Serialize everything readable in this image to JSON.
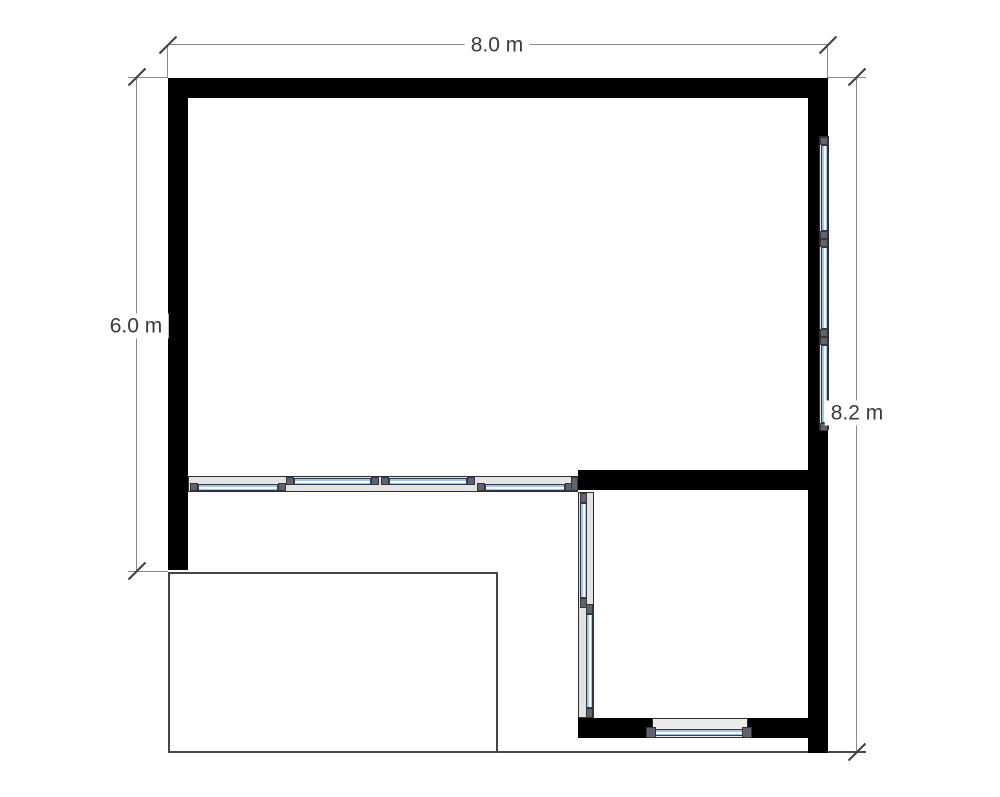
{
  "plan": {
    "dimensions": {
      "top": {
        "label": "8.0 m",
        "orientation": "horizontal"
      },
      "left": {
        "label": "6.0 m",
        "orientation": "vertical"
      },
      "right": {
        "label": "8.2 m",
        "orientation": "vertical"
      }
    },
    "colors": {
      "wall": "#000000",
      "window_glass": "#a4c4ea",
      "window_frame_band": "#e3e3e3",
      "window_cap": "#60646a",
      "dimension_line": "#8a8a8a",
      "dimension_tick": "#3f3f3f",
      "dimension_text": "#3a3a3a",
      "deck_outline": "#454545",
      "background": "#ffffff"
    }
  }
}
